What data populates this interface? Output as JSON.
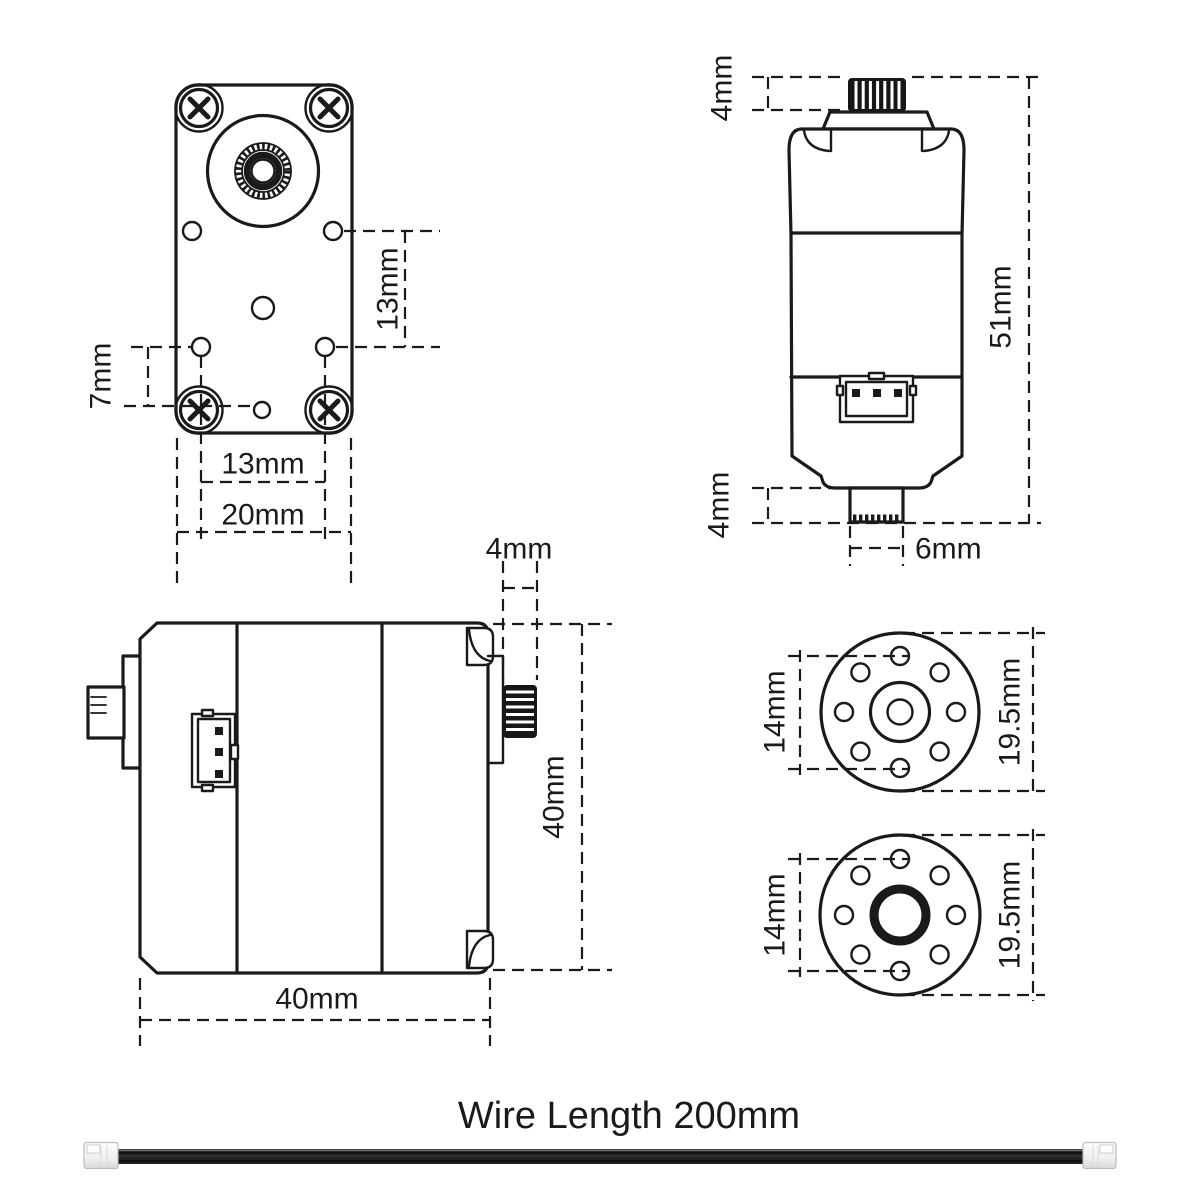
{
  "front_view": {
    "dim_hole_offset": "7mm",
    "dim_hole_spacing_vertical": "13mm",
    "dim_hole_spacing_bottom": "13mm",
    "dim_body_width": "20mm"
  },
  "top_view": {
    "dim_shaft_height": "4mm",
    "dim_body_height": "51mm",
    "dim_boss_height": "4mm",
    "dim_boss_width": "6mm"
  },
  "side_view": {
    "dim_shaft_length": "4mm",
    "dim_body_height": "40mm",
    "dim_body_length": "40mm"
  },
  "horn_front_view": {
    "dim_hole_circle": "14mm",
    "dim_outer_diameter": "19.5mm"
  },
  "horn_back_view": {
    "dim_hole_circle": "14mm",
    "dim_outer_diameter": "19.5mm"
  },
  "wire": {
    "label": "Wire Length 200mm"
  },
  "colors": {
    "line": "#1a1a1a",
    "background": "#ffffff",
    "wire_sheath": "#1c1c1c",
    "connector_housing": "#f2f2f2"
  }
}
